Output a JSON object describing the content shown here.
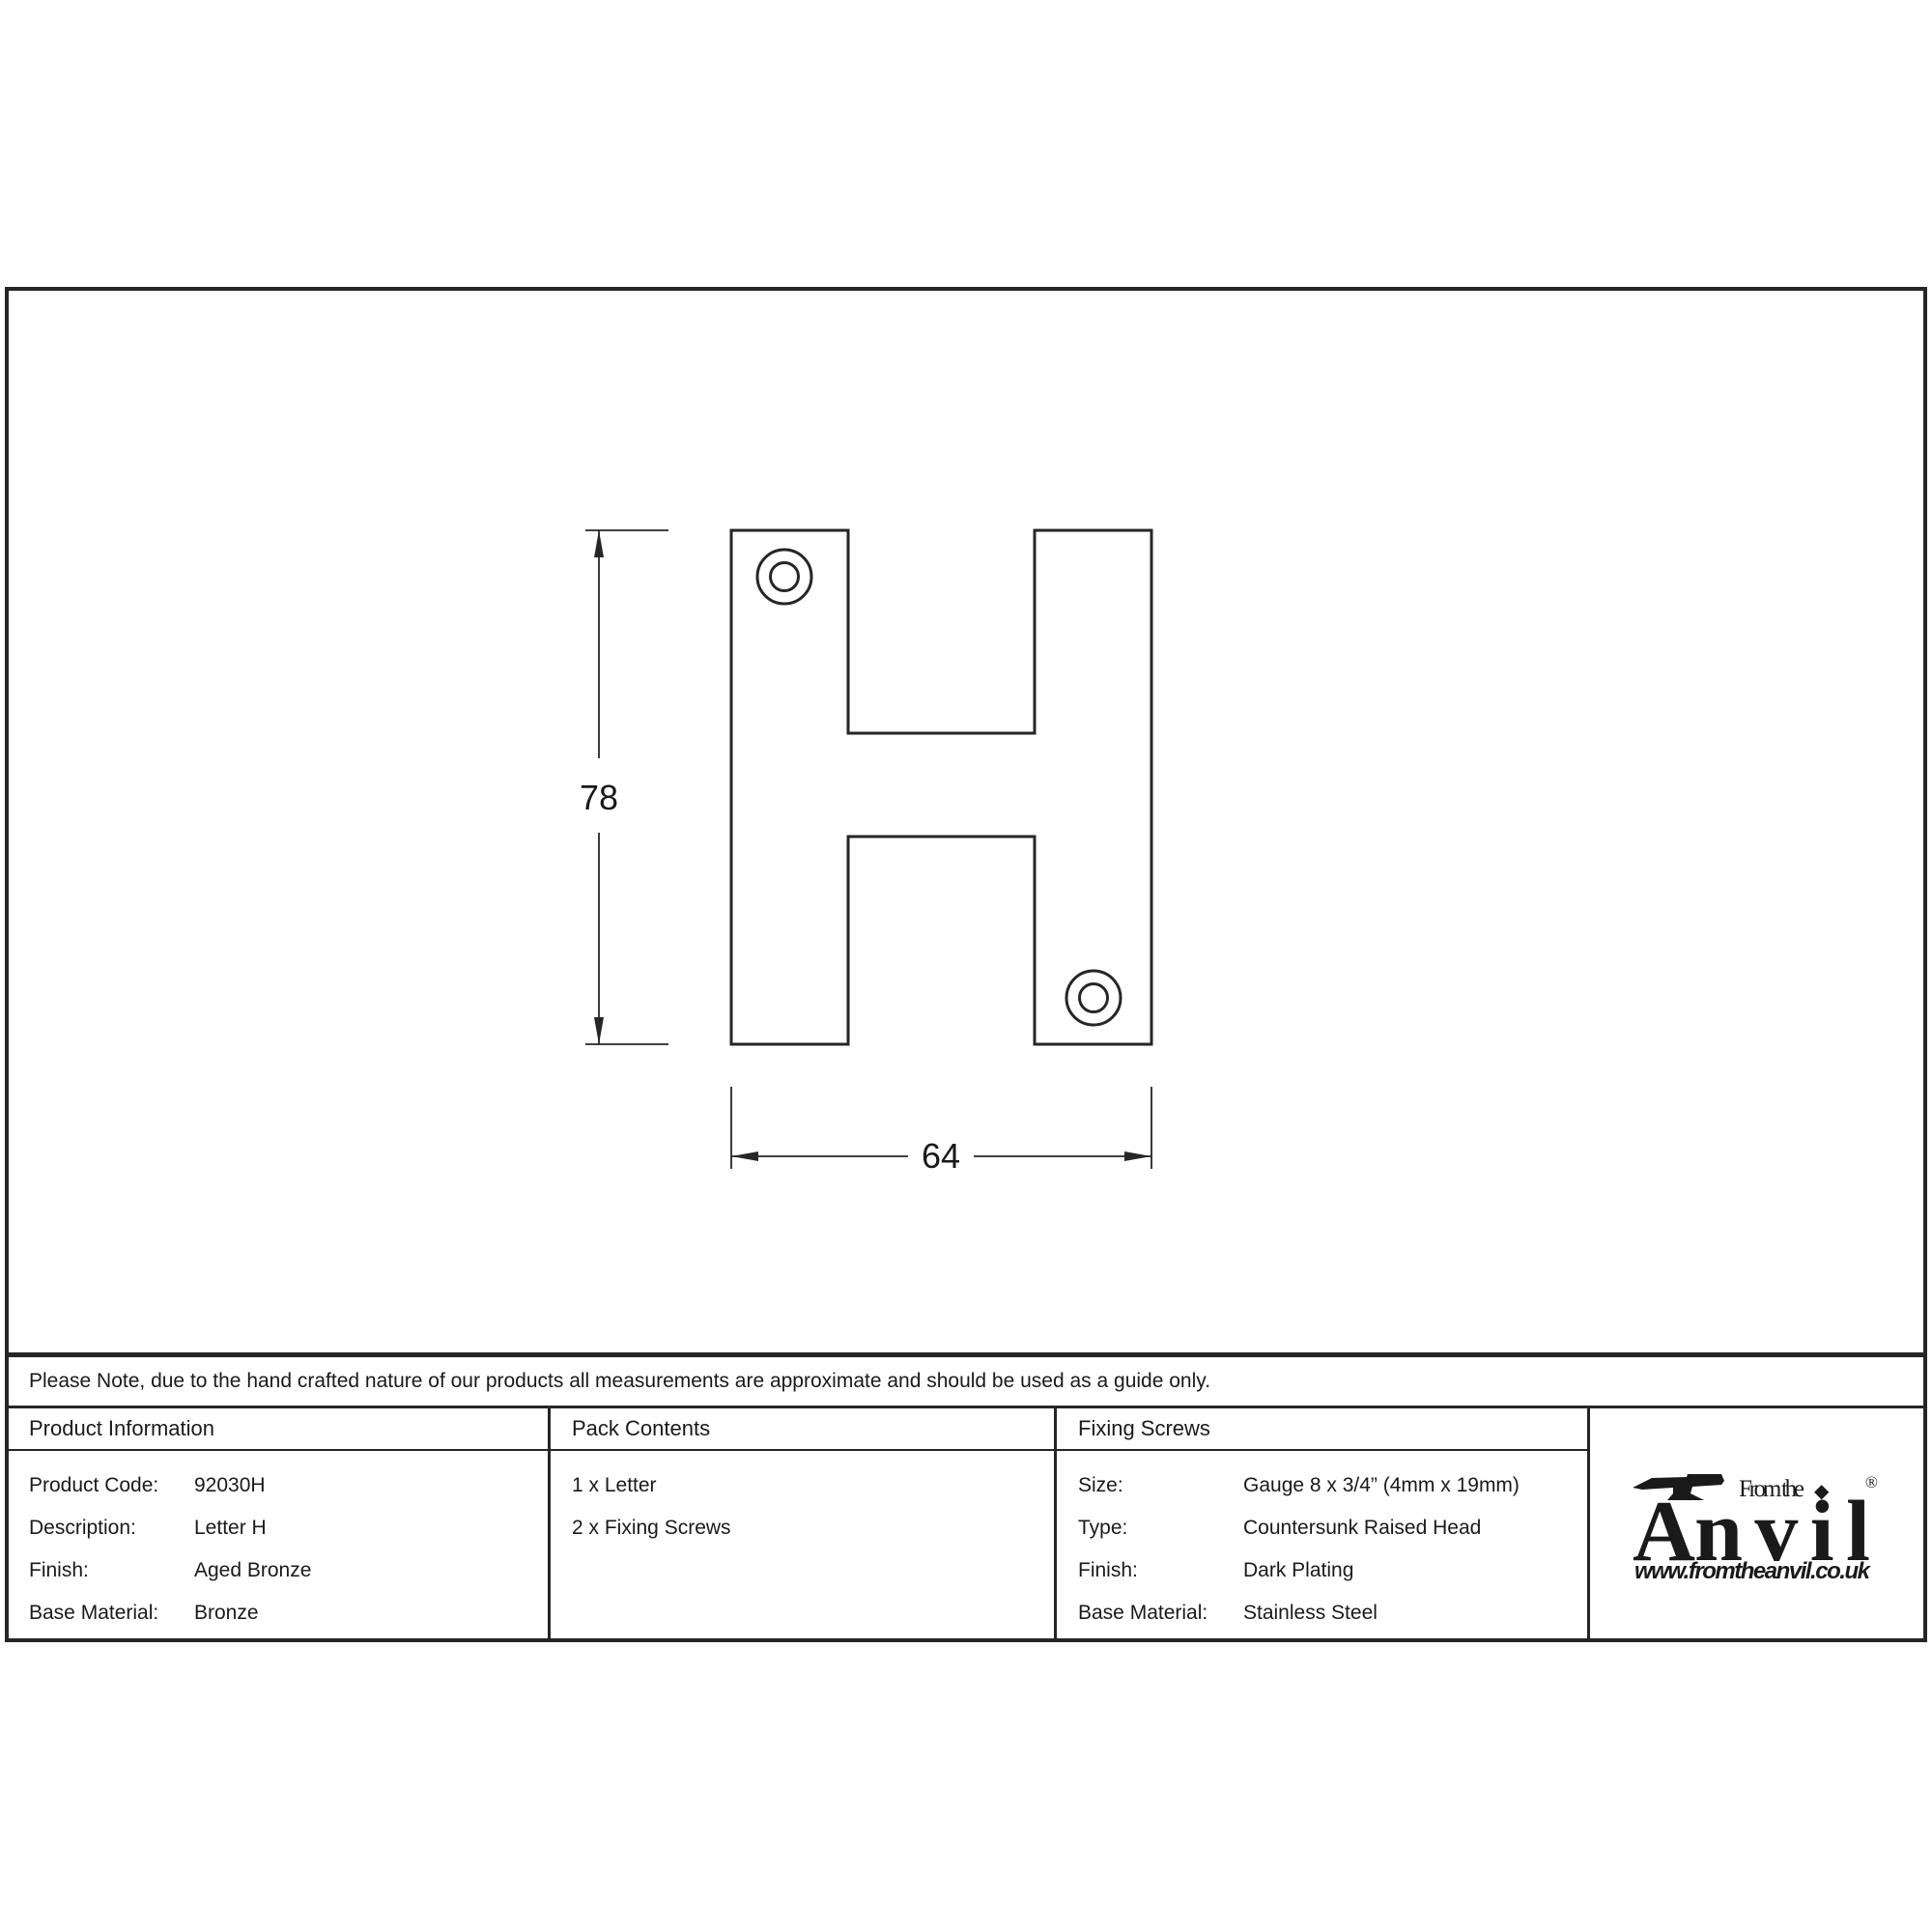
{
  "drawing": {
    "height_label": "78",
    "width_label": "64"
  },
  "note": {
    "text": "Please Note, due to the hand crafted nature of our products all measurements are approximate and should be used as a guide only."
  },
  "product_information": {
    "header": "Product Information",
    "rows": [
      {
        "label": "Product Code:",
        "value": "92030H"
      },
      {
        "label": "Description:",
        "value": "Letter H"
      },
      {
        "label": "Finish:",
        "value": "Aged Bronze"
      },
      {
        "label": "Base Material:",
        "value": "Bronze"
      }
    ]
  },
  "pack_contents": {
    "header": "Pack Contents",
    "items": [
      "1 x Letter",
      "2 x Fixing Screws"
    ]
  },
  "fixing_screws": {
    "header": "Fixing Screws",
    "rows": [
      {
        "label": "Size:",
        "value": "Gauge 8 x 3/4” (4mm x 19mm)"
      },
      {
        "label": "Type:",
        "value": "Countersunk Raised Head"
      },
      {
        "label": "Finish:",
        "value": "Dark Plating"
      },
      {
        "label": "Base Material:",
        "value": "Stainless Steel"
      }
    ]
  },
  "logo": {
    "prefix": "From the",
    "diamond": "◆",
    "brand_a": "A",
    "brand_rest": "nvil",
    "registered": "®",
    "url": "www.fromtheanvil.co.uk"
  },
  "colors": {
    "line": "#262626",
    "text": "#1a1a1a",
    "background": "#ffffff"
  }
}
